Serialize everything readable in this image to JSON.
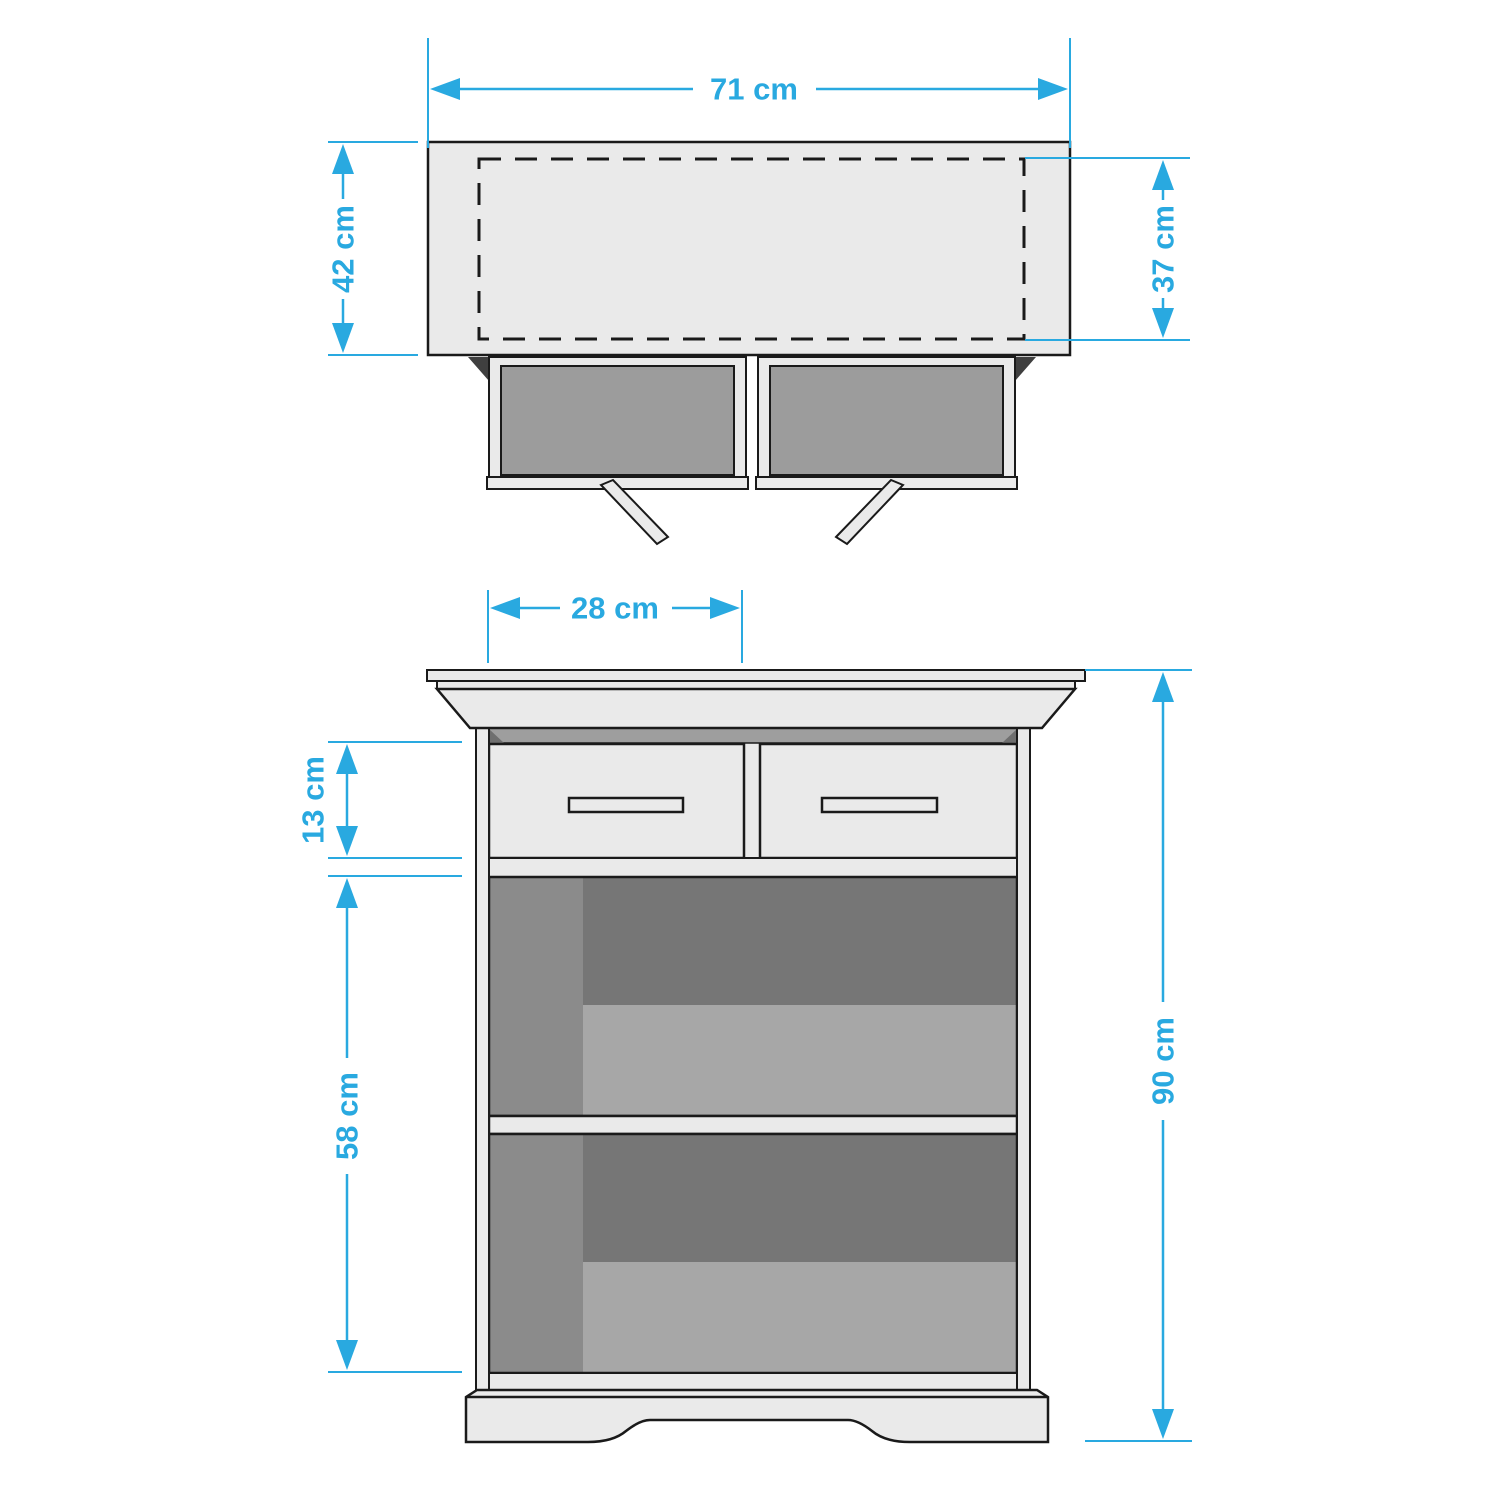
{
  "dimensions": {
    "top_width": "71 cm",
    "top_depth": "42 cm",
    "inner_depth": "37 cm",
    "drawer_width": "28 cm",
    "drawer_front_height": "13 cm",
    "open_section_height": "58 cm",
    "overall_height": "90 cm"
  },
  "colors": {
    "dimension_accent": "#29A9E0",
    "outline": "#1A1A1A",
    "surface_light": "#EAEAEA",
    "drawer_interior": "#9C9C9C",
    "compartment_back": "#767676",
    "compartment_side": "#8B8B8B",
    "compartment_floor": "#A7A7A7",
    "shadow_band": "#9E9E9E",
    "corner_wedge": "#3F3F3F",
    "background": "#FFFFFF"
  }
}
